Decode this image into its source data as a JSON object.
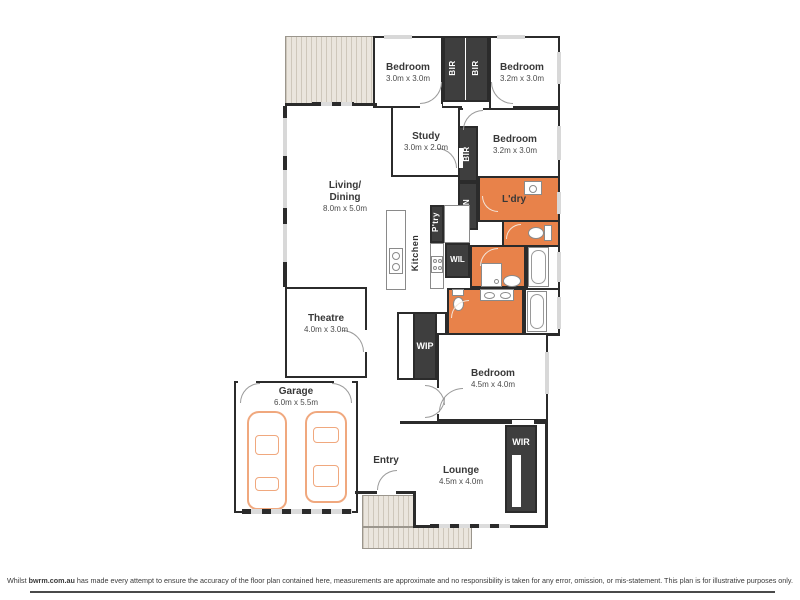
{
  "plan": {
    "rooms": {
      "bedroom1": {
        "name": "Bedroom",
        "dims": "3.0m x 3.0m"
      },
      "bedroom2": {
        "name": "Bedroom",
        "dims": "3.2m x 3.0m"
      },
      "bedroom3": {
        "name": "Bedroom",
        "dims": "3.2m x 3.0m"
      },
      "bedroom4": {
        "name": "Bedroom",
        "dims": "4.5m x 4.0m"
      },
      "study": {
        "name": "Study",
        "dims": "3.0m x 2.0m"
      },
      "living": {
        "line1": "Living/",
        "line2": "Dining",
        "dims": "8.0m x 5.0m"
      },
      "theatre": {
        "name": "Theatre",
        "dims": "4.0m x 3.0m"
      },
      "garage": {
        "name": "Garage",
        "dims": "6.0m x 5.5m"
      },
      "lounge": {
        "name": "Lounge",
        "dims": "4.5m x 4.0m"
      },
      "entry": {
        "name": "Entry"
      },
      "kitchen": {
        "name": "Kitchen"
      },
      "ldry": {
        "name": "L'dry"
      },
      "ptry": {
        "name": "P'try"
      },
      "lin": {
        "name": "LIN"
      },
      "wil": {
        "name": "WIL"
      },
      "wip": {
        "name": "WIP"
      },
      "wir": {
        "name": "WIR"
      },
      "bir1": {
        "name": "BIR"
      },
      "bir2": {
        "name": "BIR"
      },
      "bir3": {
        "name": "BIR"
      }
    },
    "colors": {
      "wall": "#2b2b2b",
      "wet_area": "#e8824a",
      "robe_fill": "#3e3e3e",
      "hatch_fill": "#eae5dd",
      "car_outline": "#f0a87e"
    }
  },
  "footer": {
    "part1": "Whilst ",
    "brand": "bwrm.com.au",
    "part2": " has made every attempt to ensure the accuracy of the floor plan contained here, measurements are approximate and no responsibility is taken for any error, omission, or mis-statement. This plan is for illustrative purposes only."
  }
}
